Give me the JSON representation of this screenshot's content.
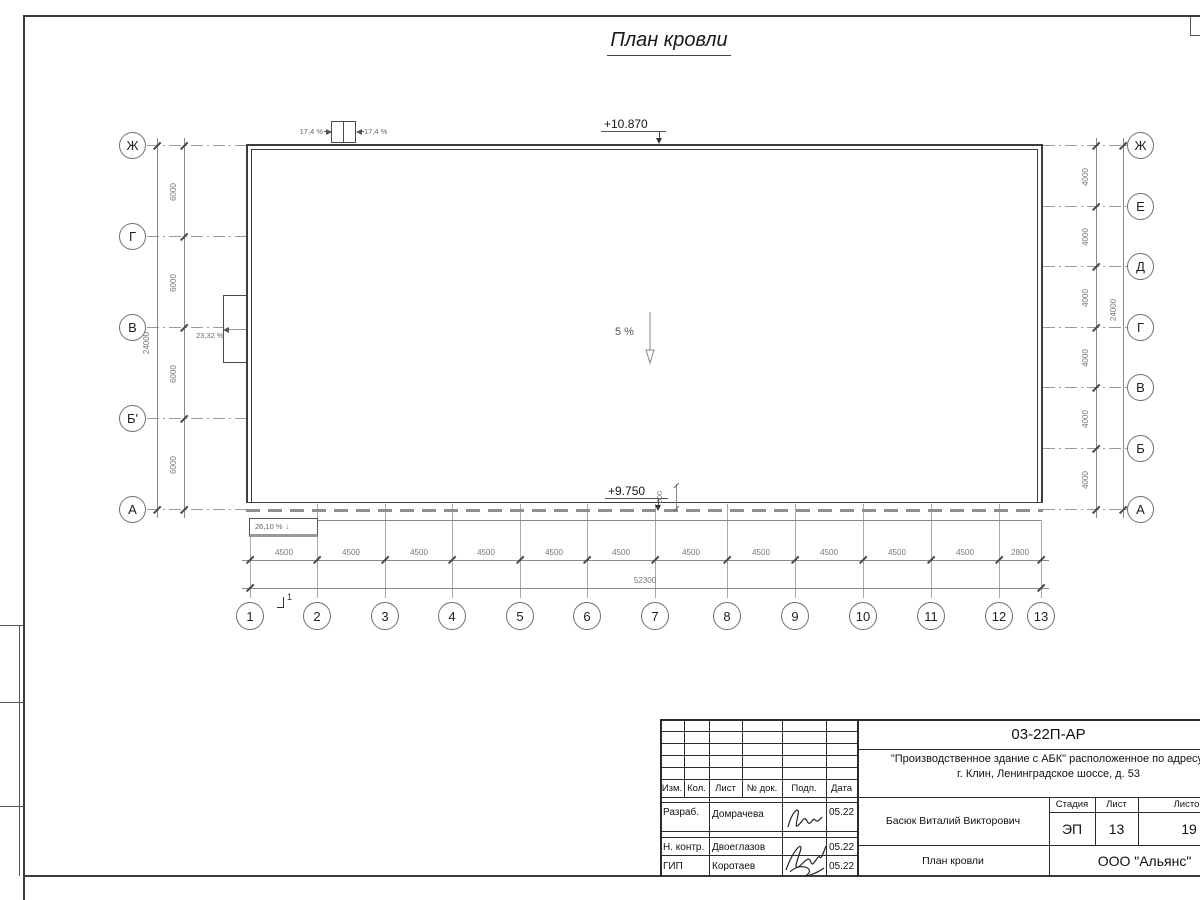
{
  "title": "План кровли",
  "plan": {
    "elevation_top": "+10.870",
    "elevation_bottom": "+9.750",
    "slope_center": "5 %",
    "slope_hatch_left": "17,4 %",
    "slope_hatch_right": "17,4 %",
    "slope_left_wall": "23,32 %",
    "slope_canopy": "26,10 %",
    "canopy_arrow": "↓",
    "dim_600": "600",
    "section_mark": "1"
  },
  "axes": {
    "left": [
      "Ж",
      "Г",
      "В",
      "Б'",
      "А"
    ],
    "right": [
      "Ж",
      "Е",
      "Д",
      "Г",
      "В",
      "Б",
      "А"
    ],
    "bottom": [
      "1",
      "2",
      "3",
      "4",
      "5",
      "6",
      "7",
      "8",
      "9",
      "10",
      "11",
      "12",
      "13"
    ]
  },
  "dimensions": {
    "left_increments": [
      "6000",
      "6000",
      "6000",
      "6000"
    ],
    "left_total": "24000",
    "right_increments": [
      "4000",
      "4000",
      "4000",
      "4000",
      "4000",
      "4000"
    ],
    "right_total": "24000",
    "bottom_increments": [
      "4500",
      "4500",
      "4500",
      "4500",
      "4500",
      "4500",
      "4500",
      "4500",
      "4500",
      "4500",
      "4500",
      "2800"
    ],
    "bottom_total": "52300"
  },
  "title_block": {
    "doc_number": "03-22П-АР",
    "project_line1": "\"Производственное здание с АБК\" расположенное по адресу:",
    "project_line2": "г. Клин, Ленинградское шоссе, д. 53",
    "col_headers": {
      "izm": "Изм.",
      "kol": "Кол.",
      "list": "Лист",
      "doc": "№ док.",
      "podp": "Подп.",
      "data": "Дата"
    },
    "rows": [
      {
        "role": "Разраб.",
        "name": "Домрачева",
        "date": "05.22"
      },
      {
        "role": "Н. контр.",
        "name": "Двоеглазов",
        "date": "05.22"
      },
      {
        "role": "ГИП",
        "name": "Коротаев",
        "date": "05.22"
      }
    ],
    "supervisor": "Басюк Виталий Викторович",
    "sheet_title": "План кровли",
    "stage_header": "Стадия",
    "sheet_header": "Лист",
    "sheets_header": "Листов",
    "stage": "ЭП",
    "sheet": "13",
    "sheets": "19",
    "company": "ООО \"Альянс\""
  }
}
